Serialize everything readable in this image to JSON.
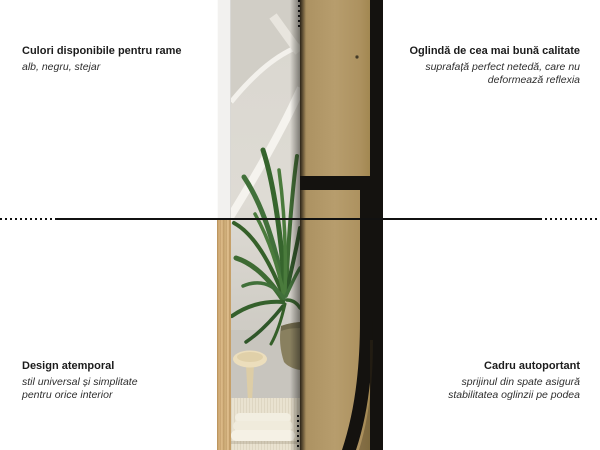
{
  "infographic": {
    "subject": "Oglindă",
    "features": {
      "top_left": {
        "title": "Culori disponibile pentru rame",
        "lines": [
          "alb, negru, stejar"
        ]
      },
      "top_right": {
        "title": "Oglindă de cea mai bună calitate",
        "lines": [
          "suprafață perfect netedă, care nu",
          "deformează reflexia"
        ]
      },
      "bottom_left": {
        "title": "Design atemporal",
        "lines": [
          "stil universal și simplitate",
          "pentru orice interior"
        ]
      },
      "bottom_right": {
        "title": "Cadru autoportant",
        "lines": [
          "sprijinul din spate asigură",
          "stabilitatea oglinzii pe podea"
        ]
      }
    }
  },
  "colors": {
    "line": "#111111",
    "title-text": "#1c1c1c",
    "subtitle-text": "#2e2e2e",
    "frame-white": "#f2f1ef",
    "frame-oak": "#d5b385",
    "frame-black": "#14120f",
    "mdf-tan": "#b79d6d",
    "mirror-wall": "#dedbd4",
    "plant-green": "#3e6b33",
    "background": "#ffffff"
  }
}
